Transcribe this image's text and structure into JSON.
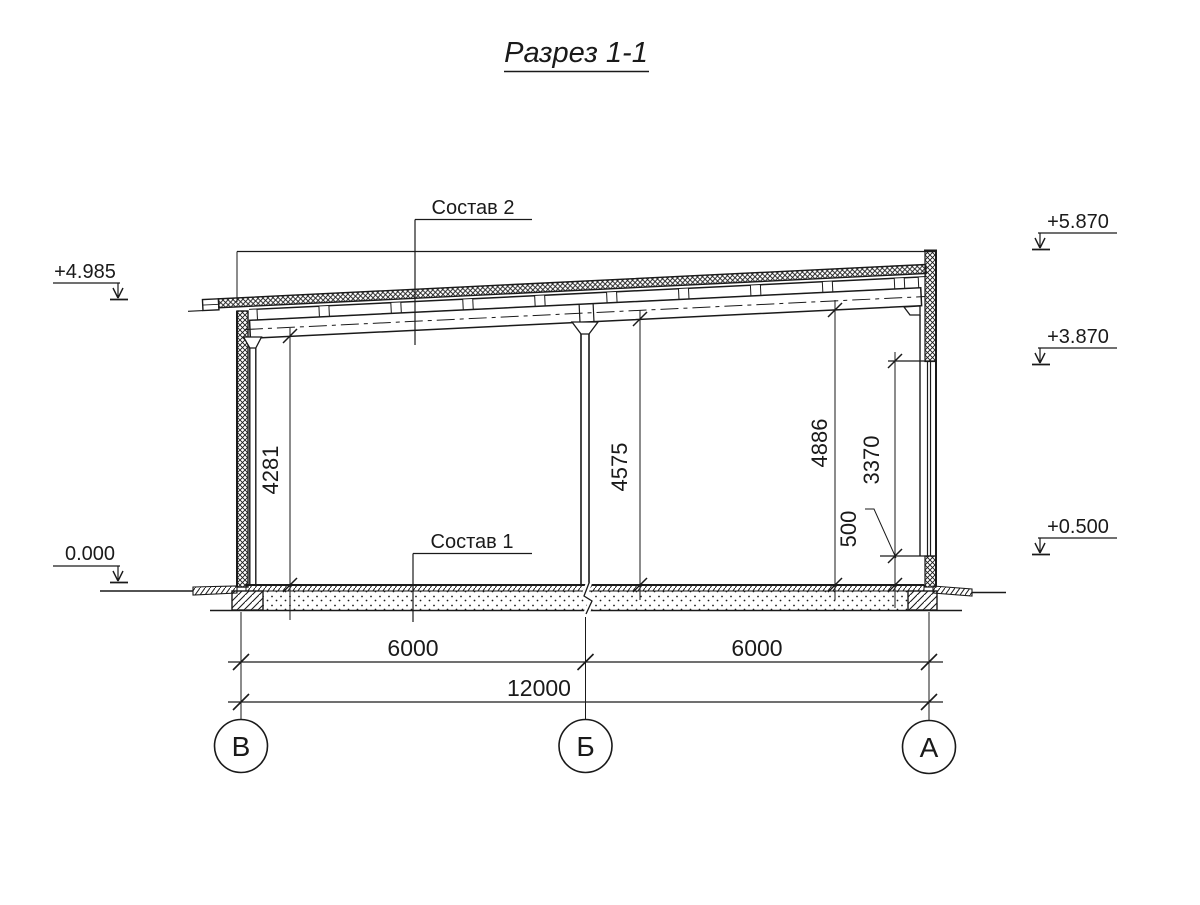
{
  "title": "Разрез 1-1",
  "elevations": {
    "left_top": "+4.985",
    "left_zero": "0.000",
    "right_top": "+5.870",
    "right_mid": "+3.870",
    "right_low": "+0.500"
  },
  "callouts": {
    "roof": "Состав 2",
    "floor": "Состав 1"
  },
  "dims": {
    "h_left": "4281",
    "h_mid": "4575",
    "h_right": "4886",
    "window": "3370",
    "sill": "500",
    "span_left": "6000",
    "span_right": "6000",
    "total": "12000"
  },
  "axes": {
    "v": "В",
    "b": "Б",
    "a": "А"
  },
  "colors": {
    "ink": "#1a1a1a",
    "paper": "#ffffff"
  }
}
